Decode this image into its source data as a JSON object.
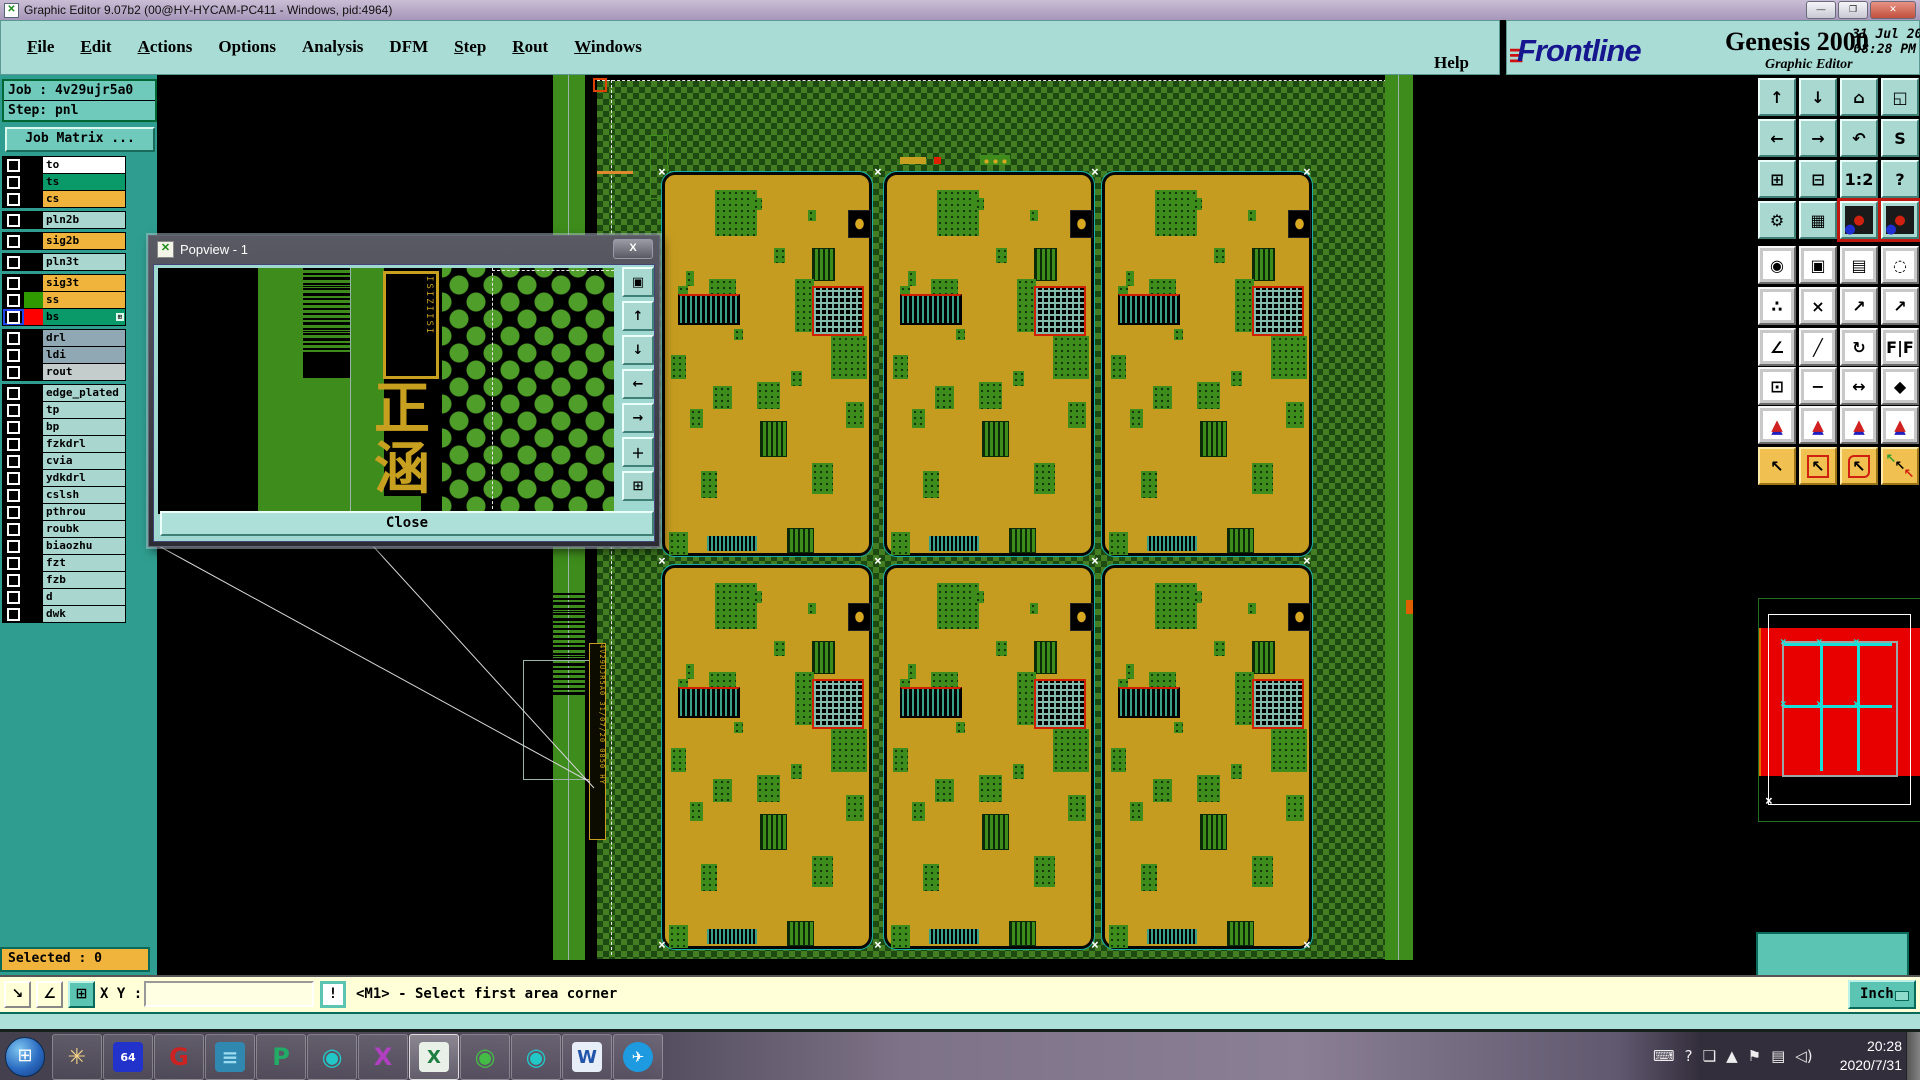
{
  "window": {
    "title": "Graphic Editor 9.07b2 (00@HY-HYCAM-PC411 - Windows, pid:4964)",
    "min": "—",
    "restore": "❐",
    "close": "✕",
    "icon": "✕"
  },
  "menu": {
    "items": [
      {
        "label": "File",
        "underline": true
      },
      {
        "label": "Edit",
        "underline": true
      },
      {
        "label": "Actions",
        "underline": true
      },
      {
        "label": "Options",
        "underline": false
      },
      {
        "label": "Analysis",
        "underline": false
      },
      {
        "label": "DFM",
        "underline": false
      },
      {
        "label": "Step",
        "underline": true
      },
      {
        "label": "Rout",
        "underline": true
      },
      {
        "label": "Windows",
        "underline": true
      }
    ],
    "help": "Help"
  },
  "brand": {
    "speed": "≡",
    "name": "Frontline",
    "product": "Genesis 2000",
    "subtitle": "Graphic Editor",
    "date": "31 Jul 2020",
    "time": "08:28 PM"
  },
  "sidebar": {
    "job": "Job : 4v29ujr5a0",
    "step": "Step: pnl",
    "job_matrix": "Job Matrix ...",
    "selected": "Selected : 0",
    "layer_groups": [
      {
        "layers": [
          {
            "name": "to",
            "fill": "#ffffff",
            "swatch": "#000000"
          },
          {
            "name": "ts",
            "fill": "#0a9a6a",
            "swatch": "#000000"
          },
          {
            "name": "cs",
            "fill": "#f0b43c",
            "swatch": "#000000"
          }
        ]
      },
      {
        "layers": [
          {
            "name": "pln2b",
            "fill": "#aad6d0",
            "swatch": "#000000"
          }
        ]
      },
      {
        "layers": [
          {
            "name": "sig2b",
            "fill": "#f0b43c",
            "swatch": "#000000"
          }
        ]
      },
      {
        "layers": [
          {
            "name": "pln3t",
            "fill": "#aad6d0",
            "swatch": "#000000"
          }
        ]
      },
      {
        "layers": [
          {
            "name": "sig3t",
            "fill": "#f0b43c",
            "swatch": "#000000"
          },
          {
            "name": "ss",
            "fill": "#f0b43c",
            "swatch": "#2f9a00"
          },
          {
            "name": "bs",
            "fill": "#0a9a6a",
            "swatch": "#ff0000",
            "active": true,
            "grid_icon": "⊞"
          }
        ]
      },
      {
        "layers": [
          {
            "name": "drl",
            "fill": "#8fa8b4",
            "swatch": "#000000"
          },
          {
            "name": "ldi",
            "fill": "#8fa8b4",
            "swatch": "#000000"
          },
          {
            "name": "rout",
            "fill": "#c4cccc",
            "swatch": "#000000"
          }
        ]
      },
      {
        "layers": [
          {
            "name": "edge_plated",
            "fill": "#aad6d0",
            "swatch": "#000000"
          },
          {
            "name": "tp",
            "fill": "#aad6d0",
            "swatch": "#000000"
          },
          {
            "name": "bp",
            "fill": "#aad6d0",
            "swatch": "#000000"
          },
          {
            "name": "fzkdrl",
            "fill": "#aad6d0",
            "swatch": "#000000"
          },
          {
            "name": "cvia",
            "fill": "#aad6d0",
            "swatch": "#000000"
          },
          {
            "name": "ydkdrl",
            "fill": "#aad6d0",
            "swatch": "#000000"
          },
          {
            "name": "cslsh",
            "fill": "#aad6d0",
            "swatch": "#000000"
          },
          {
            "name": "pthrou",
            "fill": "#aad6d0",
            "swatch": "#000000"
          },
          {
            "name": "roubk",
            "fill": "#aad6d0",
            "swatch": "#000000"
          },
          {
            "name": "biaozhu",
            "fill": "#aad6d0",
            "swatch": "#000000"
          },
          {
            "name": "fzt",
            "fill": "#aad6d0",
            "swatch": "#000000"
          },
          {
            "name": "fzb",
            "fill": "#aad6d0",
            "swatch": "#000000"
          },
          {
            "name": "d",
            "fill": "#aad6d0",
            "swatch": "#000000"
          },
          {
            "name": "dwk",
            "fill": "#aad6d0",
            "swatch": "#000000"
          }
        ]
      }
    ]
  },
  "popview": {
    "title": "Popview - 1",
    "close_x": "x",
    "close": "Close",
    "chars": [
      "正",
      "涵"
    ],
    "bracket_text": "ISIZIISI",
    "strip_text": "4V29UJR5A0 31/07/20 0850 HY",
    "side_buttons": [
      {
        "name": "popview-window-button",
        "glyph": "▣"
      },
      {
        "name": "pan-up-button",
        "glyph": "↑"
      },
      {
        "name": "pan-down-button",
        "glyph": "↓"
      },
      {
        "name": "pan-left-button",
        "glyph": "←"
      },
      {
        "name": "pan-right-button",
        "glyph": "→"
      },
      {
        "name": "zoom-fit-button",
        "glyph": "＋"
      },
      {
        "name": "zoom-center-button",
        "glyph": "⊞"
      }
    ]
  },
  "toolbar": {
    "rows": [
      [
        {
          "n": "zoom-in",
          "g": "↑",
          "c": "teal"
        },
        {
          "n": "zoom-out",
          "g": "↓",
          "c": "teal"
        },
        {
          "n": "home-view",
          "g": "⌂",
          "c": "teal"
        },
        {
          "n": "window-xy",
          "g": "◱",
          "c": "teal"
        }
      ],
      [
        {
          "n": "pan-left",
          "g": "←",
          "c": "teal"
        },
        {
          "n": "pan-right",
          "g": "→",
          "c": "teal"
        },
        {
          "n": "previous-view",
          "g": "↶",
          "c": "teal"
        },
        {
          "n": "profile",
          "g": "S",
          "c": "teal"
        }
      ],
      [
        {
          "n": "zoom-expand",
          "g": "⊞",
          "c": "teal"
        },
        {
          "n": "zoom-shrink",
          "g": "⊟",
          "c": "teal"
        },
        {
          "n": "scale-1-2",
          "g": "1:2",
          "c": "teal"
        },
        {
          "n": "help",
          "g": "?",
          "c": "teal"
        }
      ],
      [
        {
          "n": "setup-tools",
          "g": "⚙",
          "c": "teal"
        },
        {
          "n": "grid-toggle",
          "g": "▦",
          "c": "teal"
        },
        {
          "n": "netlist-a",
          "g": "●",
          "c": "teal netred"
        },
        {
          "n": "netlist-b",
          "g": "●",
          "c": "teal netred"
        }
      ],
      [
        {
          "n": "highlight-pad",
          "g": "◉",
          "c": "gray"
        },
        {
          "n": "frame-select",
          "g": "▣",
          "c": "gray"
        },
        {
          "n": "measure-ruler",
          "g": "▤",
          "c": "gray"
        },
        {
          "n": "pad-select",
          "g": "◌",
          "c": "gray"
        }
      ],
      [
        {
          "n": "net-link",
          "g": "∴",
          "c": "gray"
        },
        {
          "n": "clear-highlight",
          "g": "×",
          "c": "gray"
        },
        {
          "n": "point-measure",
          "g": "↗",
          "c": "gray"
        },
        {
          "n": "point-measure-2",
          "g": "↗",
          "c": "gray"
        }
      ],
      [
        {
          "n": "angle-measure",
          "g": "∠",
          "c": "gray"
        },
        {
          "n": "slope-measure",
          "g": "╱",
          "c": "gray"
        },
        {
          "n": "rotate",
          "g": "↻",
          "c": "gray"
        },
        {
          "n": "mirror",
          "g": "F|F",
          "c": "gray"
        }
      ],
      [
        {
          "n": "copy-pad",
          "g": "⊡",
          "c": "gray"
        },
        {
          "n": "line-measure",
          "g": "−",
          "c": "gray"
        },
        {
          "n": "width-measure",
          "g": "↔",
          "c": "gray"
        },
        {
          "n": "shape-select",
          "g": "◆",
          "c": "gray"
        }
      ],
      [
        {
          "n": "triangle-a",
          "g": "▲",
          "c": "gray tri"
        },
        {
          "n": "triangle-b",
          "g": "▲",
          "c": "gray tri"
        },
        {
          "n": "triangle-c",
          "g": "▲",
          "c": "gray tri"
        },
        {
          "n": "triangle-d",
          "g": "▲",
          "c": "gray tri"
        }
      ],
      [
        {
          "n": "select-pointer",
          "g": "↖",
          "c": "yellow"
        },
        {
          "n": "select-rect",
          "g": "↖",
          "c": "yellow selB"
        },
        {
          "n": "select-poly",
          "g": "↖",
          "c": "yellow selC"
        },
        {
          "n": "select-net",
          "g": "↖",
          "c": "yellow selD"
        }
      ]
    ]
  },
  "coords": {
    "x": "X = 7.481223\"",
    "y": "Y = 15.580005\""
  },
  "statusbar": {
    "xy_label": "X Y :",
    "input_value": "",
    "bang": "!",
    "message": "<M1> - Select first area corner",
    "unit": "Inch",
    "left_buttons": [
      {
        "name": "snap-mode-button",
        "glyph": "↘",
        "selected": false
      },
      {
        "name": "angle-mode-button",
        "glyph": "∠",
        "selected": false
      },
      {
        "name": "grid-window-button",
        "glyph": "⊞",
        "selected": true
      }
    ]
  },
  "taskbar": {
    "start_glyph": "⊞",
    "apps": [
      {
        "name": "xshell-app",
        "glyph": "✳",
        "fg": "#f4d488",
        "bg": "transparent",
        "size": 22
      },
      {
        "name": "backup64-app",
        "glyph": "64",
        "fg": "#ffffff",
        "bg": "#2233cc",
        "size": 11
      },
      {
        "name": "genesis-app",
        "glyph": "G",
        "fg": "#cc2222",
        "bg": "transparent",
        "size": 24
      },
      {
        "name": "notepad-app",
        "glyph": "≡",
        "fg": "#9adcf0",
        "bg": "#3088b0",
        "size": 20
      },
      {
        "name": "p-app",
        "glyph": "P",
        "fg": "#22aa66",
        "bg": "transparent",
        "size": 24
      },
      {
        "name": "disc-app-1",
        "glyph": "◉",
        "fg": "#22c8c8",
        "bg": "transparent",
        "size": 24
      },
      {
        "name": "xmanager-app",
        "glyph": "X",
        "fg": "#b040c0",
        "bg": "transparent",
        "size": 24
      },
      {
        "name": "excel-app",
        "glyph": "X",
        "fg": "#1e7e40",
        "bg": "#e8f0e8",
        "size": 18,
        "active": true
      },
      {
        "name": "disc-app-2",
        "glyph": "◉",
        "fg": "#44bb44",
        "bg": "transparent",
        "size": 24
      },
      {
        "name": "disc-app-3",
        "glyph": "◉",
        "fg": "#22c8c8",
        "bg": "transparent",
        "size": 24
      },
      {
        "name": "word-app",
        "glyph": "W",
        "fg": "#2255aa",
        "bg": "#e8eef8",
        "size": 18
      },
      {
        "name": "dingtalk-app",
        "glyph": "✈",
        "fg": "#ffffff",
        "bg": "#1e9ae0",
        "size": 15,
        "round": true
      }
    ],
    "tray": [
      {
        "name": "keyboard-tray-icon",
        "glyph": "⌨"
      },
      {
        "name": "help-tray-icon",
        "glyph": "?"
      },
      {
        "name": "window-tray-icon",
        "glyph": "❏"
      },
      {
        "name": "show-hidden-icon",
        "glyph": "▲"
      },
      {
        "name": "action-center-icon",
        "glyph": "⚑"
      },
      {
        "name": "network-tray-icon",
        "glyph": "▤"
      },
      {
        "name": "volume-tray-icon",
        "glyph": "◁)"
      }
    ],
    "clock_time": "20:28",
    "clock_date": "2020/7/31"
  }
}
